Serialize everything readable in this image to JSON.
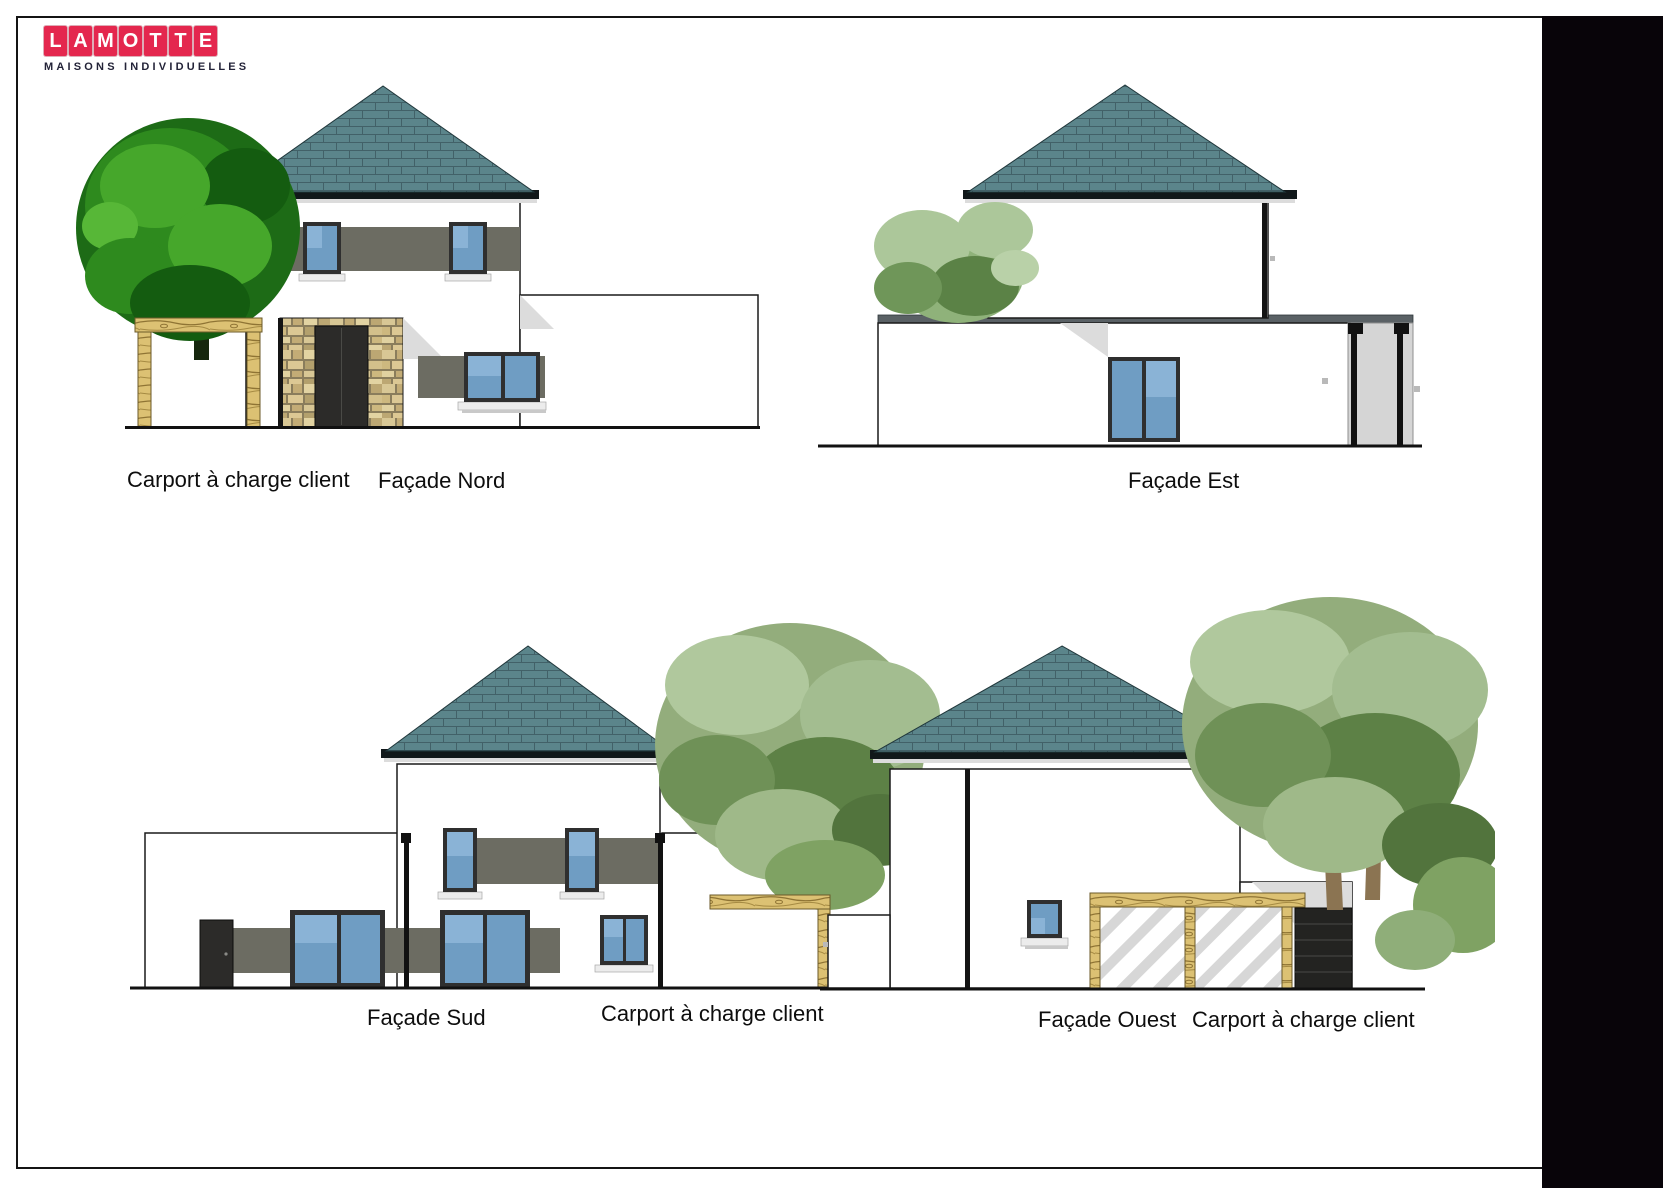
{
  "logo": {
    "brand": "LAMOTTE",
    "letters": [
      "L",
      "A",
      "M",
      "O",
      "T",
      "T",
      "E"
    ],
    "tagline": "MAISONS INDIVIDUELLES",
    "tile_color": "#e4274e",
    "letter_color": "#ffffff",
    "tagline_color": "#232338"
  },
  "elevations": {
    "nord": {
      "title": "Façade Nord",
      "carport_note": "Carport à charge client"
    },
    "est": {
      "title": "Façade Est"
    },
    "sud": {
      "title": "Façade Sud",
      "carport_note": "Carport à charge client"
    },
    "ouest": {
      "title": "Façade Ouest",
      "carport_note": "Carport à charge client"
    }
  },
  "palette": {
    "roof_tile": "#5b858b",
    "roof_tile_line": "#426168",
    "wall_white": "#ffffff",
    "window_band_grey": "#6c6c62",
    "glass_blue": "#6f9dc3",
    "glass_blue_light": "#8ab3d6",
    "frame_dark": "#2f2f2f",
    "stone_tan": "#cdb87f",
    "wood_tan": "#dcc173",
    "shadow_grey": "#dcdcdc",
    "side_wall_grey": "#d5d5d5",
    "flat_roof_grey": "#5a6165",
    "door_dark": "#2c2b29",
    "tree_green_bright": "#2e8a1e",
    "tree_green_sage": "#93ad7c",
    "trunk_brown": "#8b7452",
    "scan_strip_black": "#080409",
    "outline": "#1a1a1a"
  }
}
